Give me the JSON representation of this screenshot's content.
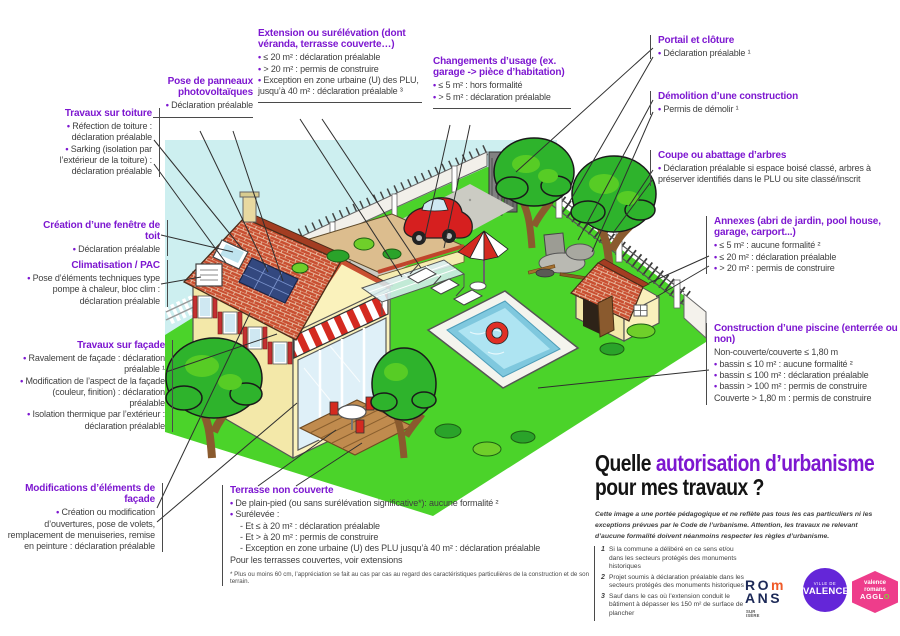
{
  "colors": {
    "purple": "#7d17d0",
    "text": "#3f3f3f",
    "sky": "#cdeff0",
    "lawn": "#4bd32a",
    "roof_red": "#c94f31",
    "pool_blue": "#9fdcee",
    "accent_red": "#d42a20",
    "valence_purple": "#6426d8",
    "agglo_pink": "#ee3d8b",
    "romans_navy": "#1c2957",
    "romans_orange": "#f05a28"
  },
  "title": {
    "q": "Quelle ",
    "hl": "autorisation d’urbanisme",
    "l2": "pour mes travaux ?"
  },
  "disclaimer": "Cette image a une portée pédagogique et ne reflète pas tous les cas particuliers ni les exceptions prévues par le Code de l’urbanisme. Attention, les travaux ne relevant d’aucune formalité doivent néanmoins respecter les règles d’urbanisme.",
  "footnotes": [
    {
      "num": "1",
      "text": "Si la commune a délibéré en ce sens et/ou dans les secteurs protégés des monuments historiques"
    },
    {
      "num": "2",
      "text": "Projet soumis à déclaration préalable dans les secteurs protégés des monuments historiques"
    },
    {
      "num": "3",
      "text": "Sauf dans le cas où l’extension conduit le bâtiment à dépasser les 150 m² de surface de plancher"
    }
  ],
  "labels": {
    "toiture": {
      "title": "Travaux sur toiture",
      "items": [
        "Réfection de toiture : déclaration préalable",
        "Sarking (isolation par l’extérieur de la toiture) : déclaration préalable"
      ]
    },
    "panneaux": {
      "title": "Pose de panneaux photovoltaïques",
      "items": [
        "Déclaration préalable"
      ]
    },
    "extension": {
      "title": "Extension ou surélévation (dont véranda, terrasse couverte…)",
      "items": [
        "≤ 20 m² : déclaration préalable",
        "> 20 m² : permis de construire",
        "Exception en zone urbaine (U) des PLU, jusqu’à 40 m² : déclaration préalable ³"
      ]
    },
    "usage": {
      "title": "Changements d’usage (ex. garage -> pièce d’habitation)",
      "items": [
        "≤ 5 m² : hors formalité",
        "> 5 m² : déclaration préalable"
      ]
    },
    "portail": {
      "title": "Portail et clôture",
      "items": [
        "Déclaration préalable ¹"
      ]
    },
    "demolition": {
      "title": "Démolition d’une construction",
      "items": [
        "Permis de démolir ¹"
      ]
    },
    "arbres": {
      "title": "Coupe ou abattage d’arbres",
      "items": [
        "Déclaration préalable si espace boisé classé, arbres à préserver identifiés dans le PLU ou site classé/inscrit"
      ]
    },
    "annexes": {
      "title": "Annexes (abri de jardin, pool house, garage, carport...)",
      "items": [
        "≤ 5 m² : aucune formalité ²",
        "≤ 20 m² : déclaration préalable",
        "> 20 m² : permis de construire"
      ]
    },
    "piscine": {
      "title": "Construction d’une piscine (enterrée ou non)",
      "intro": "Non-couverte/couverte ≤ 1,80 m",
      "items": [
        "bassin ≤ 10 m² : aucune formalité ²",
        "bassin ≤ 100 m² : déclaration préalable",
        "bassin > 100 m² : permis de construire"
      ],
      "outro": "Couverte > 1,80 m : permis de construire"
    },
    "fenetre": {
      "title": "Création d’une fenêtre de toit",
      "items": [
        "Déclaration préalable"
      ]
    },
    "clim": {
      "title": "Climatisation / PAC",
      "items": [
        "Pose d’éléments techniques type pompe à chaleur, bloc clim : déclaration préalable"
      ]
    },
    "facade": {
      "title": "Travaux sur façade",
      "items": [
        "Ravalement de façade : déclaration préalable ¹",
        "Modification de l’aspect de la façade (couleur, finition) : déclaration préalable",
        "Isolation thermique par l’extérieur : déclaration préalable"
      ]
    },
    "modifs": {
      "title": "Modifications d’éléments de façade",
      "items": [
        "Création ou modification d’ouvertures, pose de volets, remplacement de menuiseries, remise en peinture : déclaration préalable"
      ]
    },
    "terrasse": {
      "title": "Terrasse non couverte",
      "items": [
        "De plain-pied (ou sans surélévation significative*): aucune formalité ²",
        "Surélevée :",
        "- Et ≤ à 20 m² : déclaration préalable",
        "- Et > à 20 m² : permis de construire",
        "- Exception en zone urbaine (U) des PLU jusqu’à 40 m² : déclaration préalable"
      ],
      "outro": "Pour les terrasses couvertes, voir extensions",
      "footnote": "* Plus ou moins 60 cm, l’appréciation se fait au cas par cas au regard des caractéristiques particulières de la construction et de son terrain."
    }
  },
  "logos": {
    "romans": {
      "l1a": "RO",
      "l1b": "m",
      "l2": "ANS",
      "sub": "SUR ISÈRE"
    },
    "valence": {
      "top": "VILLE DE",
      "name": "VALENCE"
    },
    "agglo": {
      "l1": "valence",
      "l2": "romans",
      "l3a": "AGGL",
      "l3b": "O"
    }
  }
}
